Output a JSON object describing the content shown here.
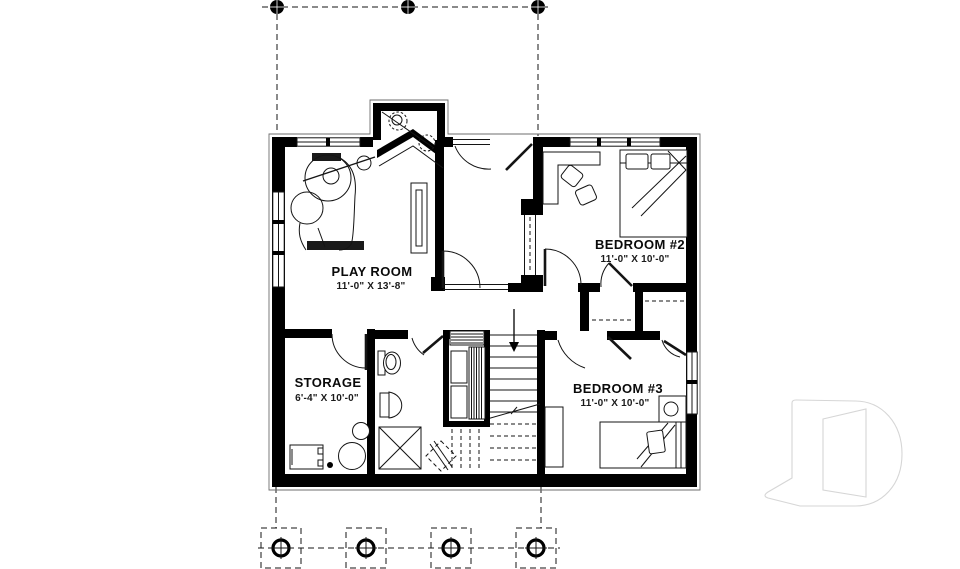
{
  "plan": {
    "type": "basement floor plan",
    "rooms": [
      {
        "name": "PLAY ROOM",
        "dimensions": "11'-0\" X 13'-8\""
      },
      {
        "name": "BEDROOM #2",
        "dimensions": "11'-0\" X 10'-0\""
      },
      {
        "name": "STORAGE",
        "dimensions": "6'-4\" X 10'-0\""
      },
      {
        "name": "BEDROOM #3",
        "dimensions": "11'-0\" X 10'-0\""
      }
    ],
    "colors": {
      "walls": "#000000",
      "lines": "#141414",
      "background": "#ffffff",
      "watermark_outline": "#d6d6d6"
    },
    "grid": {
      "top_columns": 3,
      "footings": 4
    }
  }
}
